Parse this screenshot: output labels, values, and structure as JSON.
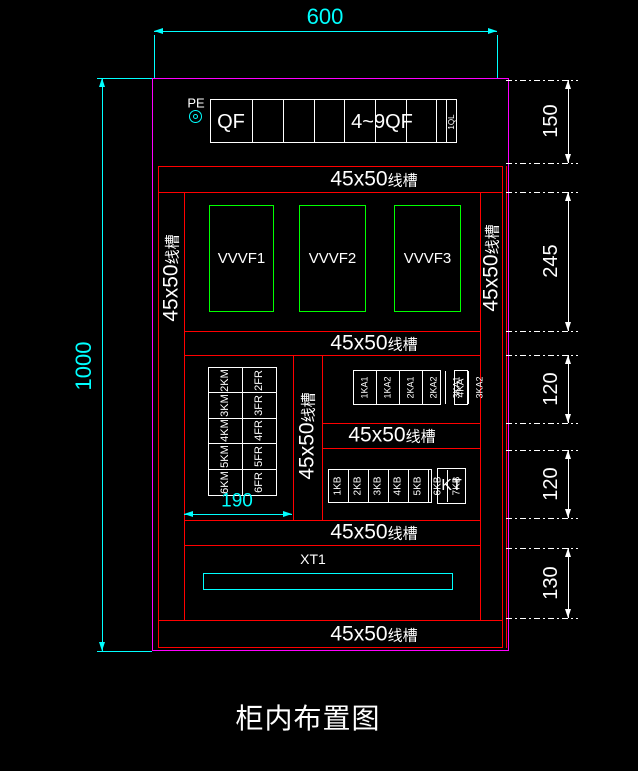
{
  "title": "柜内布置图",
  "dims": {
    "width": "600",
    "height": "1000",
    "grid_width": "190",
    "right": [
      "150",
      "245",
      "120",
      "120",
      "130"
    ]
  },
  "panel": {
    "pe": "PE",
    "qf": "QF",
    "qf_range": "4~9QF",
    "ql": "1QL"
  },
  "duct": {
    "size": "45x50",
    "type": "线槽"
  },
  "vvvf": [
    "VVVF1",
    "VVVF2",
    "VVVF3"
  ],
  "km": [
    "2KM",
    "3KM",
    "4KM",
    "5KM",
    "6KM"
  ],
  "fr": [
    "2FR",
    "3FR",
    "4FR",
    "5FR",
    "6FR"
  ],
  "ka": [
    "1KA1",
    "1KA2",
    "2KA1",
    "2KA2",
    "3KA1",
    "3KA2"
  ],
  "ka4": "4KA",
  "kb": [
    "1KB",
    "2KB",
    "3KB",
    "4KB",
    "5KB",
    "6KB",
    "7KB"
  ],
  "kt": "KT",
  "xt": "XT1",
  "colors": {
    "cabinet_outline": "#ff00ff",
    "structure": "#ff0000",
    "component": "#00ff00",
    "annotation": "#00ffff",
    "text": "#ffffff"
  }
}
